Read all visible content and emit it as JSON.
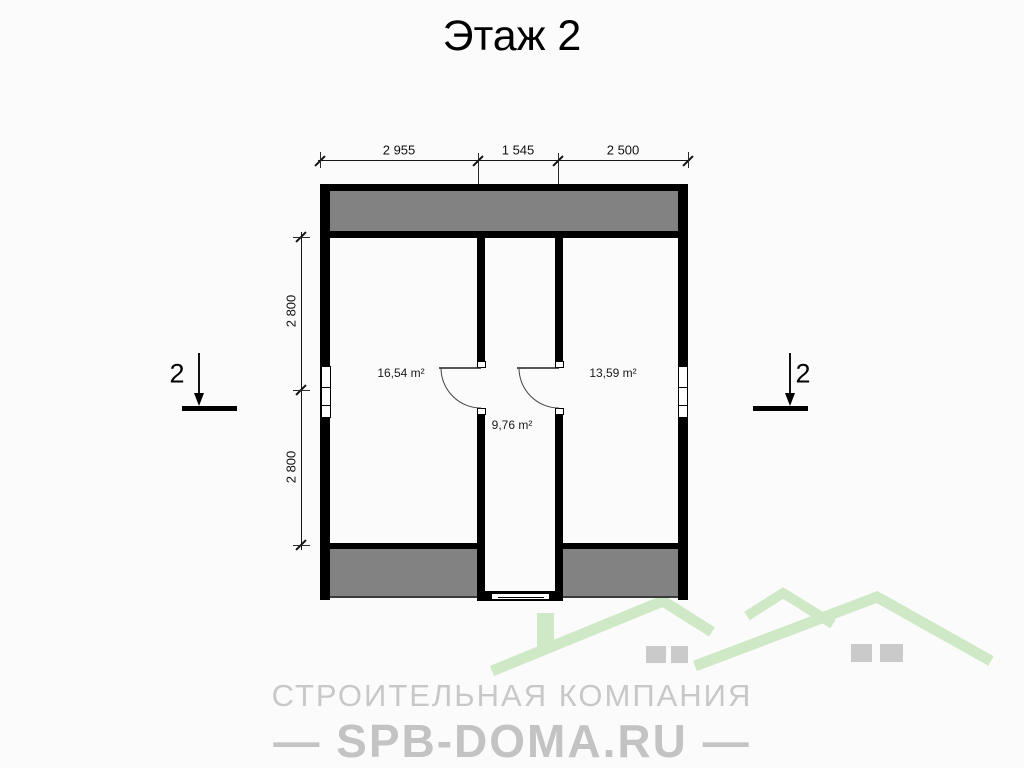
{
  "title": "Этаж 2",
  "plan": {
    "dimensions_top": [
      "2 955",
      "1 545",
      "2 500"
    ],
    "dimensions_left": [
      "2 800",
      "2 800"
    ],
    "rooms": [
      {
        "name": "left-room",
        "area": "16,54 m²"
      },
      {
        "name": "right-room",
        "area": "13,59 m²"
      },
      {
        "name": "hall",
        "area": "9,76 m²"
      }
    ],
    "section_marks": {
      "left": "2",
      "right": "2"
    }
  },
  "watermark": {
    "company_line": "СТРОИТЕЛЬНАЯ КОМПАНИЯ",
    "site_line": "— SPB-DOMA.RU —"
  },
  "colors": {
    "wall": "#000000",
    "roof_zone_gray": "#828282",
    "logo_green": "#cfe9c6",
    "logo_text_gray": "#c8c8c8",
    "background": "#fbfbfb"
  }
}
